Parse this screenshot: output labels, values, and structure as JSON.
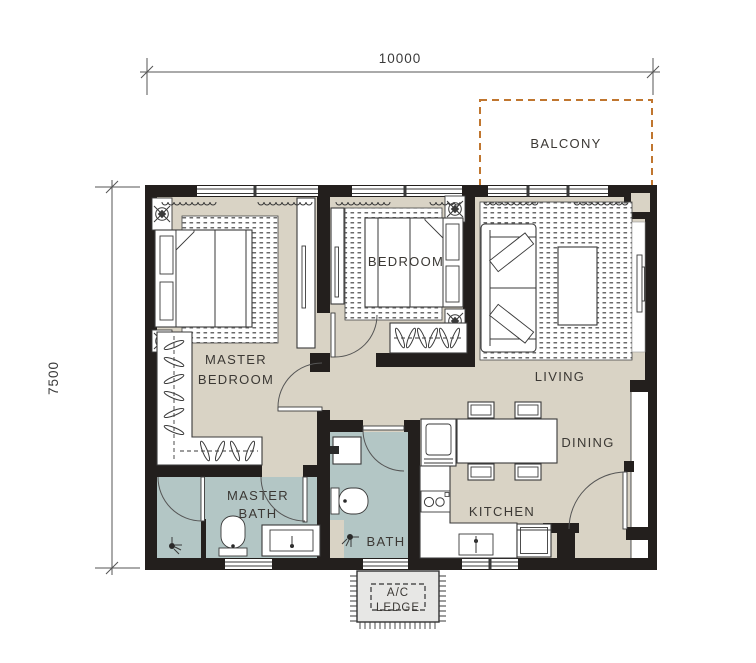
{
  "dimensions": {
    "width_label": "10000",
    "height_label": "7500"
  },
  "rooms": {
    "balcony": {
      "label": "BALCONY"
    },
    "master_bedroom": {
      "line1": "MASTER",
      "line2": "BEDROOM"
    },
    "bedroom": {
      "label": "BEDROOM"
    },
    "living": {
      "label": "LIVING"
    },
    "dining": {
      "label": "DINING"
    },
    "kitchen": {
      "label": "KITCHEN"
    },
    "master_bath": {
      "line1": "MASTER",
      "line2": "BATH"
    },
    "bath": {
      "label": "BATH"
    },
    "ac_ledge": {
      "line1": "A/C",
      "line2": "LEDGE"
    }
  },
  "colors": {
    "wall": "#231f1d",
    "floor": "#d9d3c5",
    "bathroom_floor": "#b3c6c5",
    "balcony_outline": "#c0762f",
    "ac_ledge_fill": "#e7e7e5",
    "line": "#3a3a3a"
  },
  "furniture_icons": [
    "double-bed",
    "pillow",
    "area-rug",
    "wardrobe-hangers",
    "wardrobe-panel",
    "downlight",
    "sofa",
    "coffee-table",
    "tv-panel",
    "dining-table",
    "dining-chair",
    "counter-appliance",
    "washing-machine",
    "cooktop",
    "kitchen-sink",
    "toilet",
    "vanity-sink",
    "shower-head",
    "door-swing",
    "window",
    "curtain"
  ]
}
